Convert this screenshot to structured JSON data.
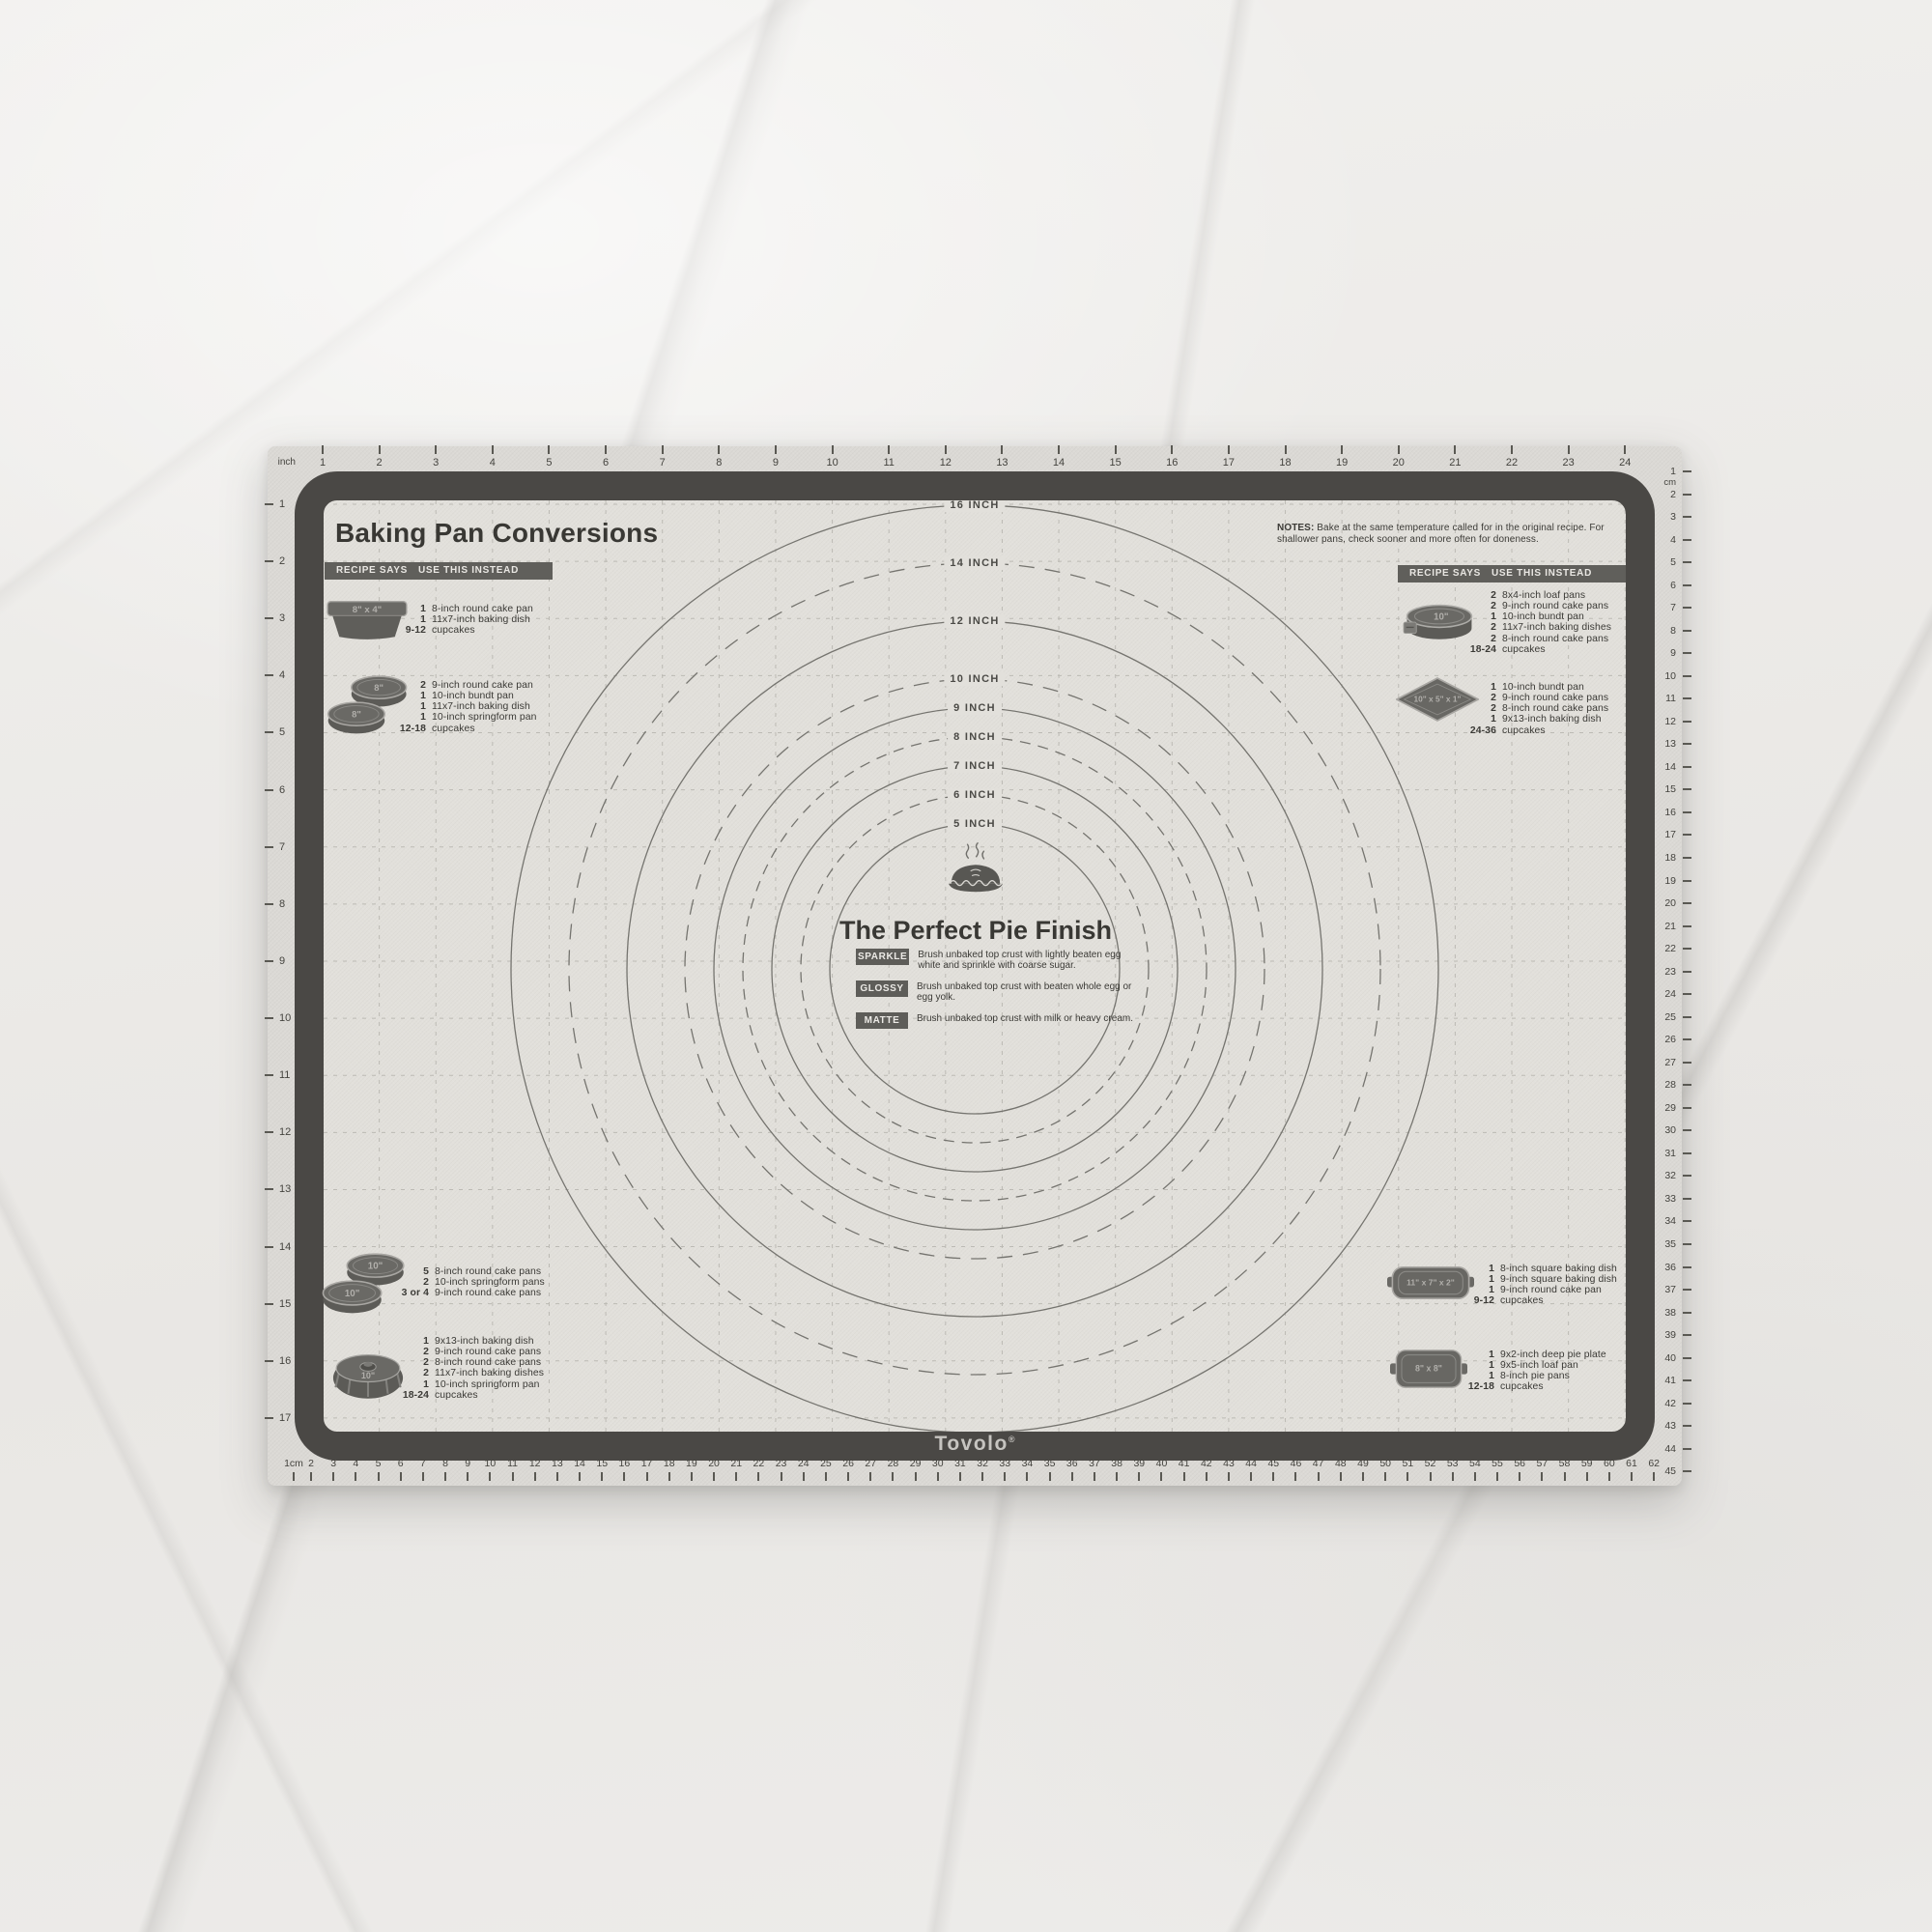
{
  "brand": {
    "name": "Tovolo",
    "reg": "®"
  },
  "title": "Baking Pan Conversions",
  "table_header": {
    "col1": "RECIPE SAYS",
    "col2": "USE THIS INSTEAD"
  },
  "notes": {
    "label": "NOTES:",
    "text": "Bake at the same temperature called for in the original recipe. For shallower pans, check sooner and more often for doneness."
  },
  "pie": {
    "title": "The Perfect Pie Finish",
    "finishes": [
      {
        "tag": "SPARKLE",
        "desc": "Brush unbaked top crust with lightly beaten egg white and sprinkle with coarse sugar."
      },
      {
        "tag": "GLOSSY",
        "desc": "Brush unbaked top crust with beaten whole egg or egg yolk."
      },
      {
        "tag": "MATTE",
        "desc": "Brush unbaked top crust with milk or heavy cream."
      }
    ]
  },
  "circles": [
    {
      "label": "16 INCH",
      "r_in": 8,
      "dashed": false
    },
    {
      "label": "14 INCH",
      "r_in": 7,
      "dashed": true
    },
    {
      "label": "12 INCH",
      "r_in": 6,
      "dashed": false
    },
    {
      "label": "10 INCH",
      "r_in": 5,
      "dashed": true
    },
    {
      "label": "9 INCH",
      "r_in": 4.5,
      "dashed": false
    },
    {
      "label": "8 INCH",
      "r_in": 4,
      "dashed": true
    },
    {
      "label": "7 INCH",
      "r_in": 3.5,
      "dashed": false
    },
    {
      "label": "6 INCH",
      "r_in": 3,
      "dashed": true
    },
    {
      "label": "5 INCH",
      "r_in": 2.5,
      "dashed": false
    }
  ],
  "rulers": {
    "top": {
      "unit": "inch",
      "values": [
        "1",
        "2",
        "3",
        "4",
        "5",
        "6",
        "7",
        "8",
        "9",
        "10",
        "11",
        "12",
        "13",
        "14",
        "15",
        "16",
        "17",
        "18",
        "19",
        "20",
        "21",
        "22",
        "23",
        "24"
      ]
    },
    "left": {
      "values": [
        "1",
        "2",
        "3",
        "4",
        "5",
        "6",
        "7",
        "8",
        "9",
        "10",
        "11",
        "12",
        "13",
        "14",
        "15",
        "16",
        "17"
      ]
    },
    "right": {
      "first": "1",
      "unit": "cm",
      "values": [
        "2",
        "3",
        "4",
        "5",
        "6",
        "7",
        "8",
        "9",
        "10",
        "11",
        "12",
        "13",
        "14",
        "15",
        "16",
        "17",
        "18",
        "19",
        "20",
        "21",
        "22",
        "23",
        "24",
        "25",
        "26",
        "27",
        "28",
        "29",
        "30",
        "31",
        "32",
        "33",
        "34",
        "35",
        "36",
        "37",
        "38",
        "39",
        "40",
        "41",
        "42",
        "43",
        "44",
        "45"
      ]
    },
    "bottom": {
      "first": "1cm",
      "values": [
        "2",
        "3",
        "4",
        "5",
        "6",
        "7",
        "8",
        "9",
        "10",
        "11",
        "12",
        "13",
        "14",
        "15",
        "16",
        "17",
        "18",
        "19",
        "20",
        "21",
        "22",
        "23",
        "24",
        "25",
        "26",
        "27",
        "28",
        "29",
        "30",
        "31",
        "32",
        "33",
        "34",
        "35",
        "36",
        "37",
        "38",
        "39",
        "40",
        "41",
        "42",
        "43",
        "44",
        "45",
        "46",
        "47",
        "48",
        "49",
        "50",
        "51",
        "52",
        "53",
        "54",
        "55",
        "56",
        "57",
        "58",
        "59",
        "60",
        "61",
        "62"
      ]
    }
  },
  "conversions": [
    {
      "id": "e1",
      "icon": "loaf-pan",
      "icon_label": "8\" x 4\"",
      "items": [
        [
          "1",
          "8-inch round cake pan"
        ],
        [
          "1",
          "11x7-inch baking dish"
        ],
        [
          "9-12",
          "cupcakes"
        ]
      ]
    },
    {
      "id": "e2",
      "icon": "round-pans",
      "icon_label": "8\"",
      "icon_label2": "8\"",
      "items": [
        [
          "2",
          "9-inch round cake pan"
        ],
        [
          "1",
          "10-inch bundt pan"
        ],
        [
          "1",
          "11x7-inch baking dish"
        ],
        [
          "1",
          "10-inch springform pan"
        ],
        [
          "12-18",
          "cupcakes"
        ]
      ]
    },
    {
      "id": "e3",
      "icon": "springform-pan",
      "icon_label": "10\"",
      "items": [
        [
          "2",
          "8x4-inch loaf pans"
        ],
        [
          "2",
          "9-inch round cake pans"
        ],
        [
          "1",
          "10-inch bundt pan"
        ],
        [
          "2",
          "11x7-inch baking dishes"
        ],
        [
          "2",
          "8-inch round cake pans"
        ],
        [
          "18-24",
          "cupcakes"
        ]
      ]
    },
    {
      "id": "e4",
      "icon": "tube-pan",
      "icon_label": "10\" x 5\" x 1\"",
      "items": [
        [
          "1",
          "10-inch bundt pan"
        ],
        [
          "2",
          "9-inch round cake pans"
        ],
        [
          "2",
          "8-inch round cake pans"
        ],
        [
          "1",
          "9x13-inch baking dish"
        ],
        [
          "24-36",
          "cupcakes"
        ]
      ]
    },
    {
      "id": "e5",
      "icon": "round-pans",
      "icon_label": "10\"",
      "icon_label2": "10\"",
      "items": [
        [
          "5",
          "8-inch round cake pans"
        ],
        [
          "2",
          "10-inch springform pans"
        ],
        [
          "3 or 4",
          "9-inch round cake pans"
        ]
      ]
    },
    {
      "id": "e6",
      "icon": "bundt-pan",
      "icon_label": "10\"",
      "items": [
        [
          "1",
          "9x13-inch baking dish"
        ],
        [
          "2",
          "9-inch round cake pans"
        ],
        [
          "2",
          "8-inch round cake pans"
        ],
        [
          "2",
          "11x7-inch baking dishes"
        ],
        [
          "1",
          "10-inch springform pan"
        ],
        [
          "18-24",
          "cupcakes"
        ]
      ]
    },
    {
      "id": "e7",
      "icon": "rect-dish",
      "icon_label": "11\" x 7\" x 2\"",
      "items": [
        [
          "1",
          "8-inch square baking dish"
        ],
        [
          "1",
          "9-inch square baking dish"
        ],
        [
          "1",
          "9-inch round cake pan"
        ],
        [
          "9-12",
          "cupcakes"
        ]
      ]
    },
    {
      "id": "e8",
      "icon": "square-dish",
      "icon_label": "8\" x 8\"",
      "items": [
        [
          "1",
          "9x2-inch deep pie plate"
        ],
        [
          "1",
          "9x5-inch loaf pan"
        ],
        [
          "1",
          "8-inch pie pans"
        ],
        [
          "12-18",
          "cupcakes"
        ]
      ]
    }
  ],
  "colors": {
    "frame": "#4a4845",
    "mat": "#e2e0db",
    "edge": "#dbd9d5",
    "ink": "#3b3a36",
    "tag_bg": "#5e5d59",
    "circle_line": "#75746f"
  }
}
